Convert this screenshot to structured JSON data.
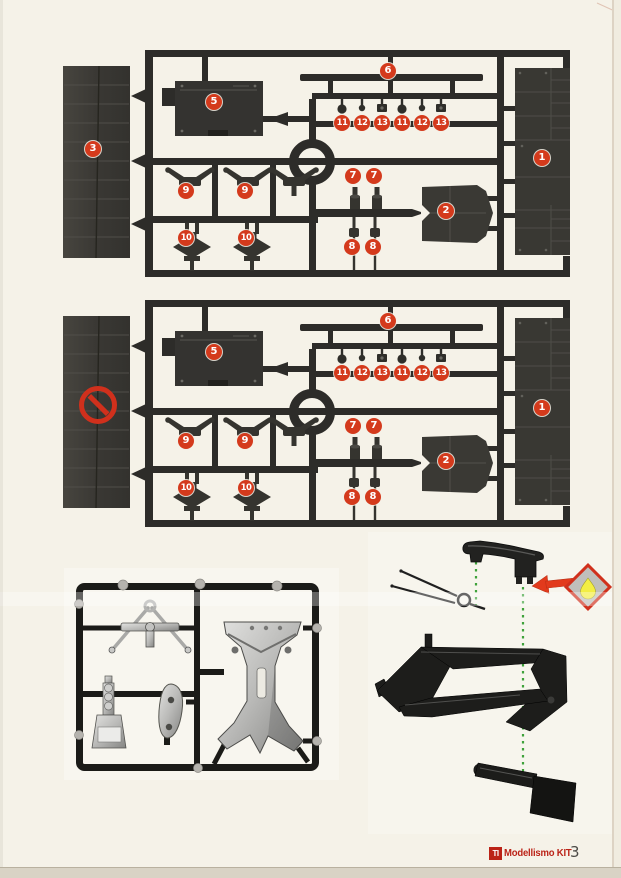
{
  "footer": {
    "brand_mark": "TI",
    "brand_name": "Modellismo KIT",
    "page_number": "3"
  },
  "colors": {
    "page_background": "#f5f2e8",
    "badge_red": "#d43a1c",
    "prohibition_red": "#d0301c",
    "logo_red": "#bb2317",
    "green_dotted_line": "#3fa23b",
    "glue_arrow_red": "#e23a1c",
    "glue_drop_yellow": "#f3ee43",
    "sprue_dark": "#2d2c29"
  },
  "sprues": [
    {
      "layer": "badge-layer-sprue-a",
      "badges": [
        {
          "label": "3",
          "x": 93,
          "y": 149
        },
        {
          "label": "5",
          "x": 214,
          "y": 102
        },
        {
          "label": "6",
          "x": 388,
          "y": 71
        },
        {
          "label": "11",
          "x": 342,
          "y": 123
        },
        {
          "label": "12",
          "x": 362,
          "y": 123
        },
        {
          "label": "13",
          "x": 382,
          "y": 123
        },
        {
          "label": "11",
          "x": 402,
          "y": 123
        },
        {
          "label": "12",
          "x": 422,
          "y": 123
        },
        {
          "label": "13",
          "x": 441,
          "y": 123
        },
        {
          "label": "1",
          "x": 542,
          "y": 158
        },
        {
          "label": "9",
          "x": 186,
          "y": 191
        },
        {
          "label": "9",
          "x": 245,
          "y": 191
        },
        {
          "label": "7",
          "x": 353,
          "y": 176
        },
        {
          "label": "7",
          "x": 374,
          "y": 176
        },
        {
          "label": "2",
          "x": 446,
          "y": 211
        },
        {
          "label": "10",
          "x": 186,
          "y": 238
        },
        {
          "label": "10",
          "x": 246,
          "y": 238
        },
        {
          "label": "8",
          "x": 352,
          "y": 247
        },
        {
          "label": "8",
          "x": 373,
          "y": 247
        }
      ]
    },
    {
      "layer": "badge-layer-sprue-b",
      "prohibited": true,
      "badges": [
        {
          "label": "5",
          "x": 214,
          "y": 352
        },
        {
          "label": "6",
          "x": 388,
          "y": 321
        },
        {
          "label": "11",
          "x": 342,
          "y": 373
        },
        {
          "label": "12",
          "x": 362,
          "y": 373
        },
        {
          "label": "13",
          "x": 382,
          "y": 373
        },
        {
          "label": "11",
          "x": 402,
          "y": 373
        },
        {
          "label": "12",
          "x": 422,
          "y": 373
        },
        {
          "label": "13",
          "x": 441,
          "y": 373
        },
        {
          "label": "1",
          "x": 542,
          "y": 408
        },
        {
          "label": "9",
          "x": 186,
          "y": 441
        },
        {
          "label": "9",
          "x": 245,
          "y": 441
        },
        {
          "label": "7",
          "x": 353,
          "y": 426
        },
        {
          "label": "7",
          "x": 374,
          "y": 426
        },
        {
          "label": "2",
          "x": 446,
          "y": 461
        },
        {
          "label": "10",
          "x": 186,
          "y": 488
        },
        {
          "label": "10",
          "x": 246,
          "y": 488
        },
        {
          "label": "8",
          "x": 352,
          "y": 497
        },
        {
          "label": "8",
          "x": 373,
          "y": 497
        }
      ]
    }
  ]
}
